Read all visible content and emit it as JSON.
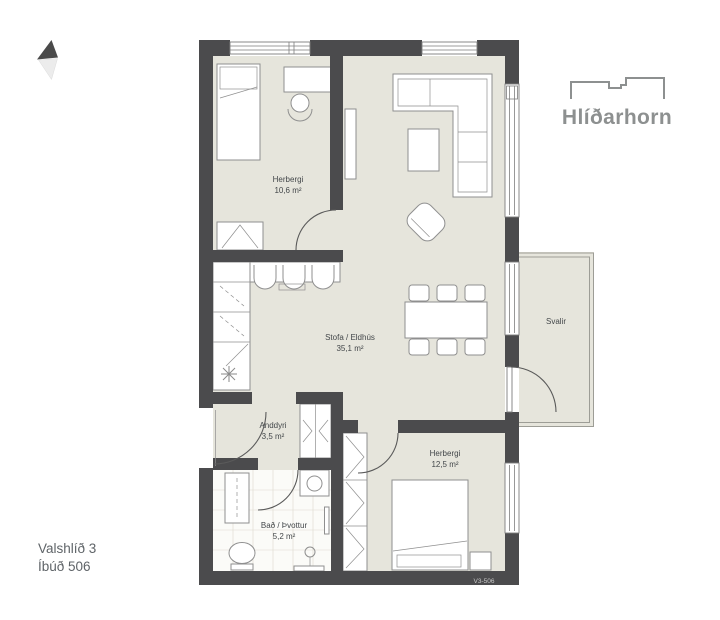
{
  "theme": {
    "wall": "#4b4b4d",
    "floor": "#e6e5dc",
    "line": "#8f8f8f",
    "label": "#43474a",
    "logo": "#8d9090"
  },
  "logo": {
    "name": "Hlíðarhorn"
  },
  "project": {
    "address": "Valshlíð 3",
    "unit": "Íbúð 506"
  },
  "plan": {
    "code": "V3-506",
    "rooms": [
      {
        "name": "Herbergi",
        "area": "10,6 m²"
      },
      {
        "name": "Stofa / Eldhús",
        "area": "35,1 m²"
      },
      {
        "name": "Anddyri",
        "area": "3,5 m²"
      },
      {
        "name": "Bað / Þvottur",
        "area": "5,2 m²"
      },
      {
        "name": "Herbergi",
        "area": "12,5 m²"
      },
      {
        "name": "Svalir",
        "area": ""
      }
    ]
  }
}
